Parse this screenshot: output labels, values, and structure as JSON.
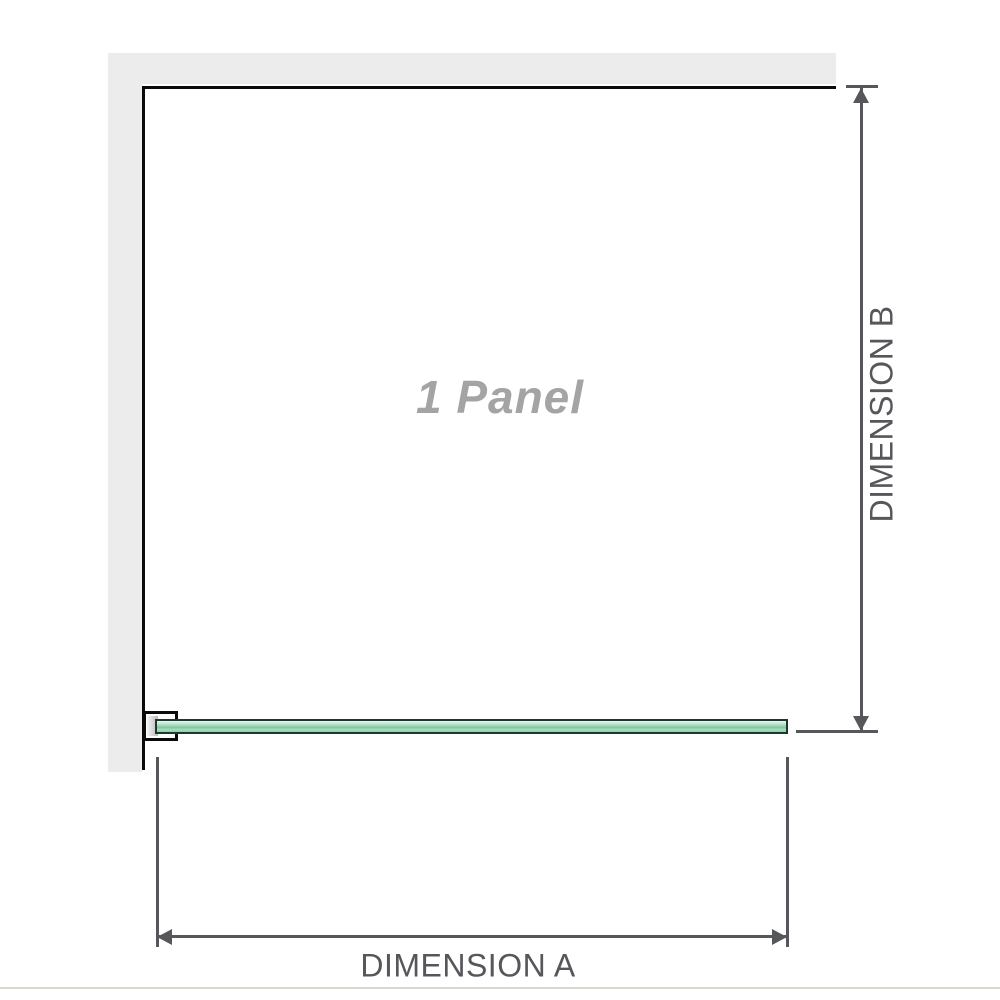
{
  "diagram": {
    "panel_label": "1 Panel",
    "dimension_a_label": "DIMENSION A",
    "dimension_b_label": "DIMENSION B",
    "colors": {
      "wall": "#ececec",
      "outline": "#0a0a0a",
      "dimension": "#56575a",
      "panel_text": "#a4a4a4",
      "glass_border": "#1c3a29",
      "glass_fill": "#9dd5b7",
      "divider": "#dadad2"
    }
  }
}
